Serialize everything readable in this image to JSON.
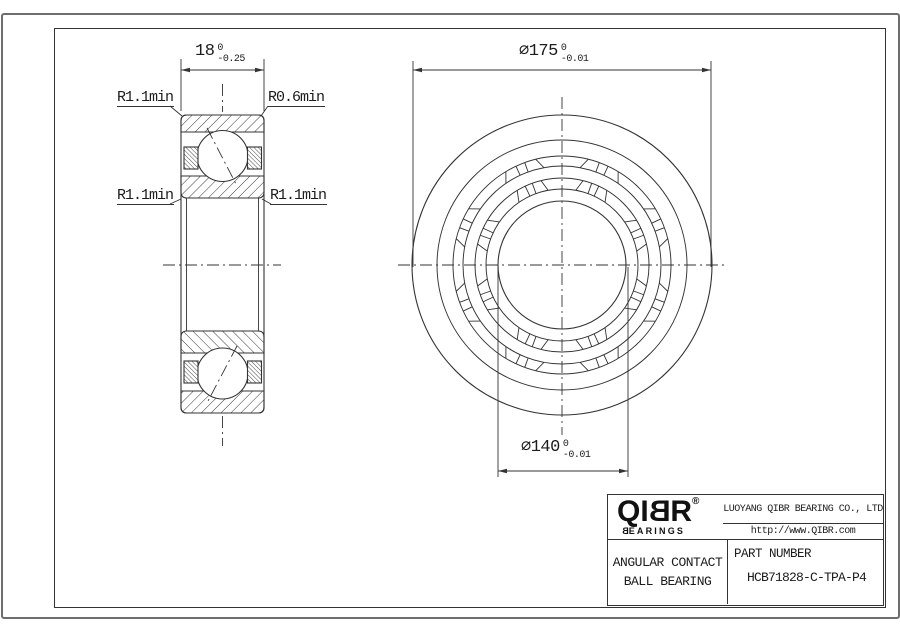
{
  "page": {
    "dimensions": {
      "width": {
        "label": "18",
        "tol_upper": "0",
        "tol_lower": "-0.25"
      },
      "outer_diameter": {
        "label": "⌀175",
        "tol_upper": "0",
        "tol_lower": "-0.01"
      },
      "bore_diameter": {
        "label": "⌀140",
        "tol_upper": "0",
        "tol_lower": "-0.01"
      }
    },
    "radius_labels": {
      "top_left": "R1.1min",
      "top_right": "R0.6min",
      "mid_left": "R1.1min",
      "mid_right": "R1.1min"
    },
    "title_block": {
      "logo": {
        "part1": "QI",
        "part2": "B",
        "part3": "R",
        "registered": "®",
        "sub_part1": "B",
        "sub_part2": "EARINGS"
      },
      "company": "LUOYANG QIBR BEARING CO., LTD",
      "website": "http://www.QIBR.com",
      "product": {
        "line1": "ANGULAR CONTACT",
        "line2": "BALL BEARING"
      },
      "part_number_label": "PART NUMBER",
      "part_number": "HCB71828-C-TPA-P4"
    },
    "colors": {
      "line": "#333333",
      "text": "#1c1c1c"
    }
  }
}
